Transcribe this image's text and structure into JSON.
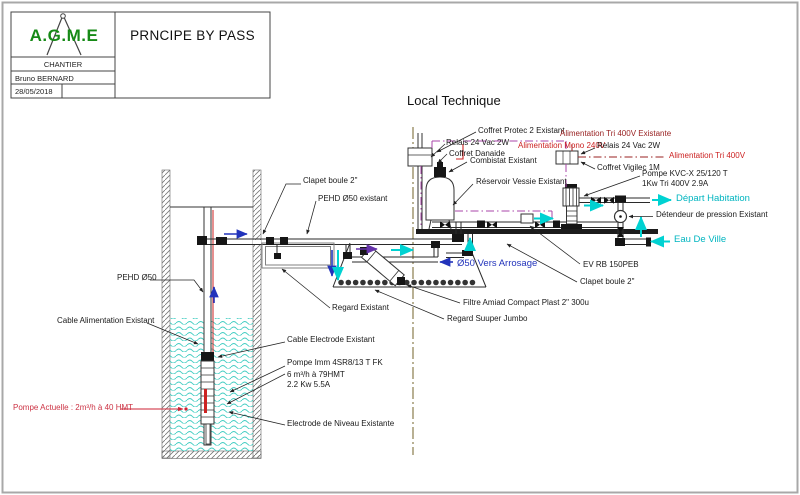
{
  "title_block": {
    "logo": "A.G.M.E",
    "row1": "CHANTIER",
    "row2": "Bruno BERNARD",
    "row3": "28/05/2018",
    "title": "PRNCIPE BY PASS"
  },
  "heading": {
    "local_technique": "Local Technique"
  },
  "labels": {
    "coffret_protec": "Coffret Protec 2 Existant",
    "relais_left": "Relais 24 Vac 2W",
    "alim_mono": "Alimentation Mono 240V",
    "alim_tri_existante": "Alimentation Tri 400V Existante",
    "relais_right": "Relais 24 Vac 2W",
    "alim_tri": "Alimentation Tri 400V",
    "coffret_danaide": "Coffret Danaide",
    "combistat": "Combistat Existant",
    "reservoir_vessie": "Réservoir Vessie Existant",
    "coffret_vigilec": "Coffret Vigilec 1M",
    "pompe_kvc_1": "Pompe KVC-X 25/120 T",
    "pompe_kvc_2": "1Kw Tri 400V 2.9A",
    "depart_habitation": "Départ Habitation",
    "detendeur": "Détendeur de pression Existant",
    "eau_de_ville": "Eau De Ville",
    "ev_rb": "EV RB 150PEB",
    "clapet_boule_right": "Clapet boule 2\"",
    "vers_arrosage": "Ø50 Vers Arrosage",
    "filtre_amiad": "Filtre Amiad Compact Plast 2\" 300u",
    "regard_jumbo": "Regard Suuper Jumbo",
    "regard_existant": "Regard Existant",
    "clapet_boule_left": "Clapet boule 2\"",
    "pehd_existant": "PEHD Ø50 existant",
    "pehd_50": "PEHD Ø50",
    "cable_alimentation": "Cable Alimentation Existant",
    "cable_electrode": "Cable Electrode Existant",
    "pompe_imm_1": "Pompe Imm 4SR8/13 T FK",
    "pompe_imm_2": "6 m³/h à 79HMT",
    "pompe_imm_3": "2.2 Kw 5.5A",
    "electrode_niveau": "Electrode de Niveau Existante",
    "pompe_actuelle": "Pompe Actuelle : 2m³/h à 40 HMT"
  },
  "colors": {
    "label_cyan": "#00b5c0",
    "flow_cyan": "#00d2d2",
    "label_blue": "#2233bb",
    "label_red": "#cc2222",
    "label_dark_red": "#992222",
    "wire_purple": "#aa44aa",
    "axis_olive": "#8a7d4e",
    "logo_green": "#168a16",
    "water": "#3fccc1"
  }
}
